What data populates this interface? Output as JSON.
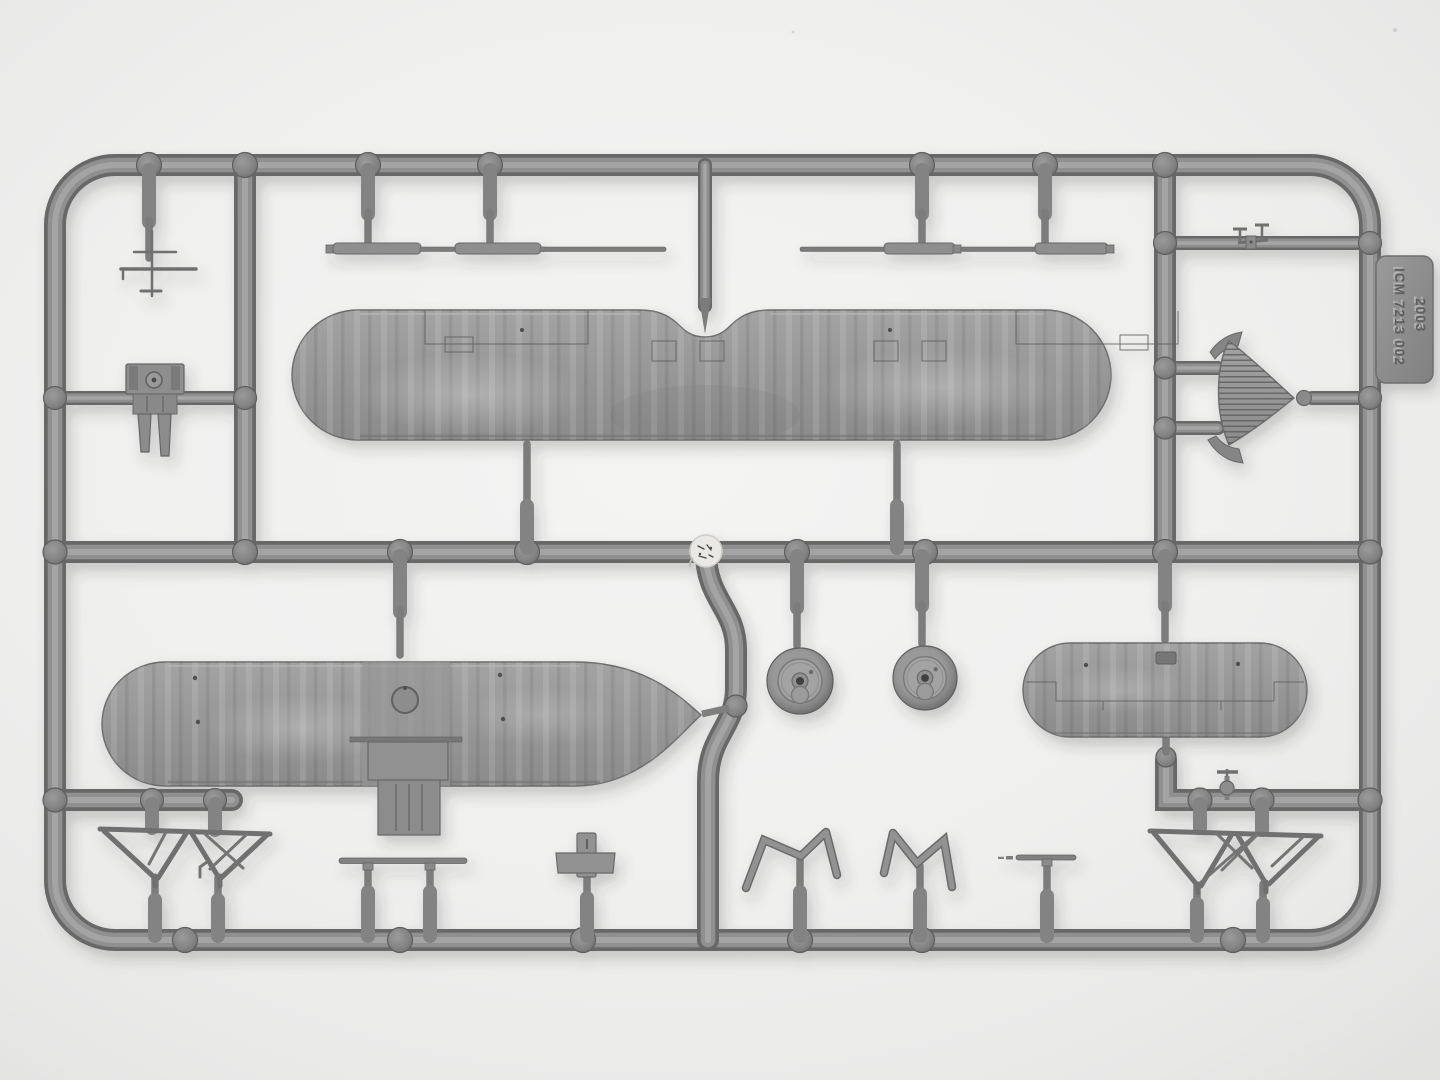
{
  "scene": {
    "type": "photograph",
    "subject": "Gray injection-molded polystyrene sprue of 1/72 biplane model-kit parts on a white backdrop",
    "background_color": "#efefee",
    "plastic_color": "#8f8f8f",
    "plastic_shadow_color": "#676767",
    "plastic_highlight_color": "#aaaaaa",
    "injection_point_color": "#eae8e4"
  },
  "tag": {
    "line1": "ICM 7213 002",
    "line2": "2003"
  },
  "parts": [
    {
      "name": "upper-wing"
    },
    {
      "name": "lower-wing-with-center-section"
    },
    {
      "name": "small-wing-panel"
    },
    {
      "name": "wheel",
      "count": 2
    },
    {
      "name": "engine-block"
    },
    {
      "name": "ribbed-radiator-cowl"
    },
    {
      "name": "interplane-strut",
      "count": 4
    },
    {
      "name": "cabane-strut-frame",
      "count": 2
    },
    {
      "name": "v-strut",
      "count": 2
    },
    {
      "name": "cross-fitting"
    },
    {
      "name": "axle-rod"
    },
    {
      "name": "pitot-rod"
    },
    {
      "name": "aerial-mast"
    },
    {
      "name": "gun-linkage"
    },
    {
      "name": "valve-fitting"
    }
  ]
}
